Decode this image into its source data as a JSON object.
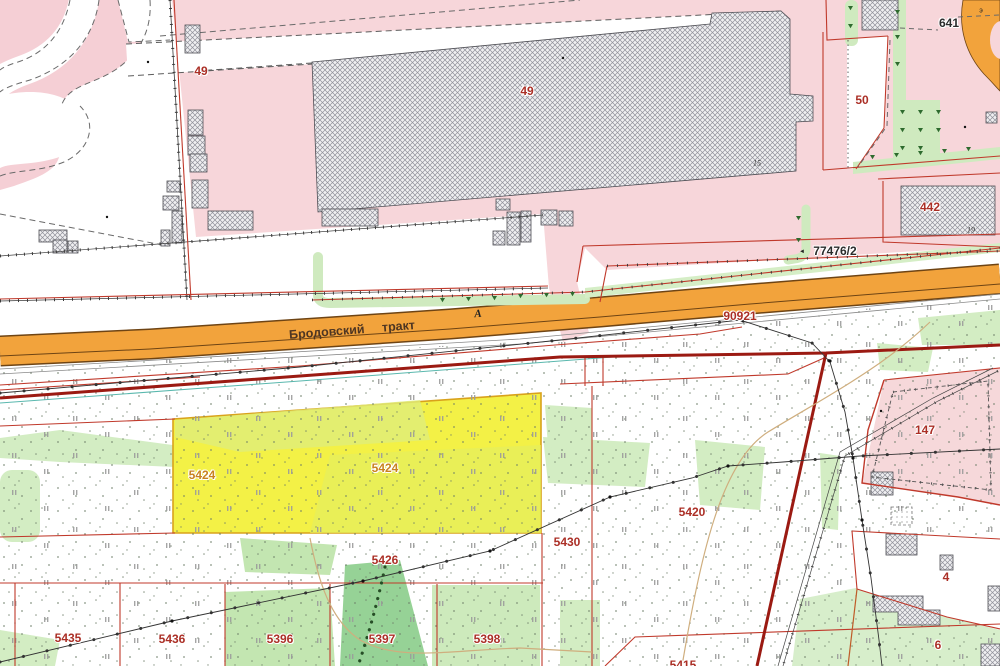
{
  "map_type": "cadastral-map",
  "road": {
    "name": "Бродовский тракт",
    "class_marker": "А"
  },
  "labels": [
    {
      "id": "parcel-49-west",
      "text": "49"
    },
    {
      "id": "building-49",
      "text": "49"
    },
    {
      "id": "parcel-641",
      "text": "641"
    },
    {
      "id": "parcel-50",
      "text": "50"
    },
    {
      "id": "parcel-442",
      "text": "442"
    },
    {
      "id": "note-19",
      "text": "19"
    },
    {
      "id": "note-15",
      "text": "15"
    },
    {
      "id": "parcel-77476-2",
      "text": "77476/2"
    },
    {
      "id": "road-name",
      "text": "Бродовский тракт"
    },
    {
      "id": "road-class",
      "text": "А"
    },
    {
      "id": "parcel-90921",
      "text": "90921"
    },
    {
      "id": "parcel-147",
      "text": "147"
    },
    {
      "id": "parcel-5424-a",
      "text": "5424"
    },
    {
      "id": "parcel-5424-b",
      "text": "5424"
    },
    {
      "id": "parcel-5420",
      "text": "5420"
    },
    {
      "id": "parcel-5430",
      "text": "5430"
    },
    {
      "id": "parcel-5426",
      "text": "5426"
    },
    {
      "id": "parcel-5435",
      "text": "5435"
    },
    {
      "id": "parcel-5436",
      "text": "5436"
    },
    {
      "id": "parcel-5396",
      "text": "5396"
    },
    {
      "id": "parcel-5397",
      "text": "5397"
    },
    {
      "id": "parcel-5398",
      "text": "5398"
    },
    {
      "id": "parcel-4",
      "text": "4"
    },
    {
      "id": "parcel-6",
      "text": "6"
    },
    {
      "id": "parcel-5415",
      "text": "5415"
    },
    {
      "id": "note-e",
      "text": "э"
    },
    {
      "id": "pointer-77476",
      "text": "◄"
    }
  ],
  "colors": {
    "urban_pink": "#f7d6da",
    "pink_blob": "#f5cfd5",
    "road_fill_orange": "#f2a33c",
    "road_casing_brown": "#6e4414",
    "parcel_line_red": "#c0392b",
    "thick_boundary_red": "#9b1a12",
    "highlight_yellow": "#f3f146",
    "veg_light_green": "#d3edc3",
    "veg_medium_green": "#c3e6b1",
    "veg_dark_green": "#96d296",
    "label_red": "#ab2f26",
    "label_orange": "#c8821f",
    "utility_teal": "#5ab8ae",
    "path_tan": "#cfae7e"
  }
}
